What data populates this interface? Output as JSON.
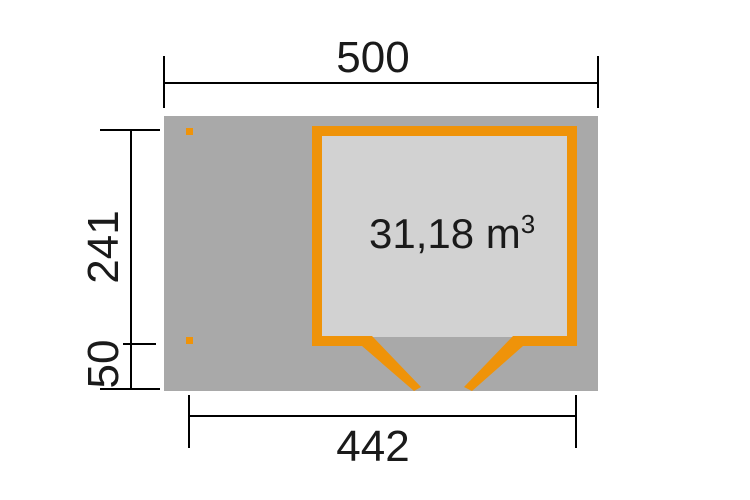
{
  "diagram": {
    "title_hint": "shed floor plan",
    "volume": {
      "text": "31,18 m",
      "exponent": "3"
    },
    "dimensions": {
      "width_total": "500",
      "width_front": "442",
      "depth_main": "241",
      "depth_overhang": "50"
    }
  },
  "colors": {
    "orange": "#EF9309",
    "ground_gray": "#A9A9A9",
    "interior_gray": "#D2D2D2",
    "line_black": "#000000",
    "text_dark": "#1A1A1A",
    "background": "#FFFFFF"
  }
}
